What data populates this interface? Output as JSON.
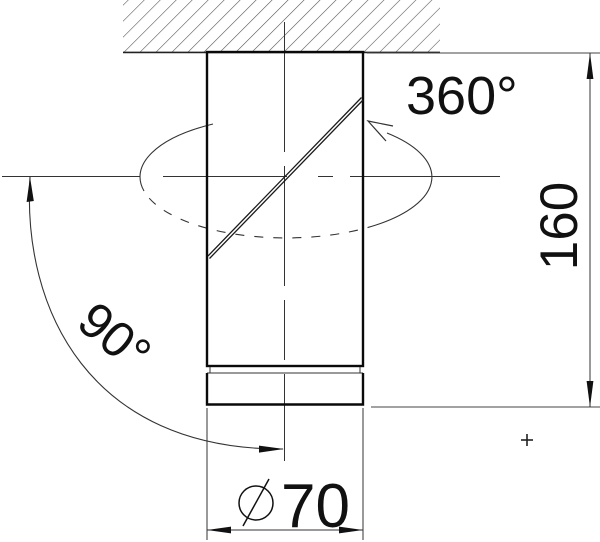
{
  "drawing": {
    "rotation_label": "360°",
    "height_label": "160",
    "tilt_label": "90°",
    "diameter_value": "70"
  },
  "symbols": {
    "diameter_symbol": "⌀",
    "registration_mark": "+"
  },
  "colors": {
    "background": "#ffffff",
    "outline": "#0a0a0a",
    "thin_line": "#333333",
    "hatch_line": "#555555",
    "text": "#111111"
  }
}
